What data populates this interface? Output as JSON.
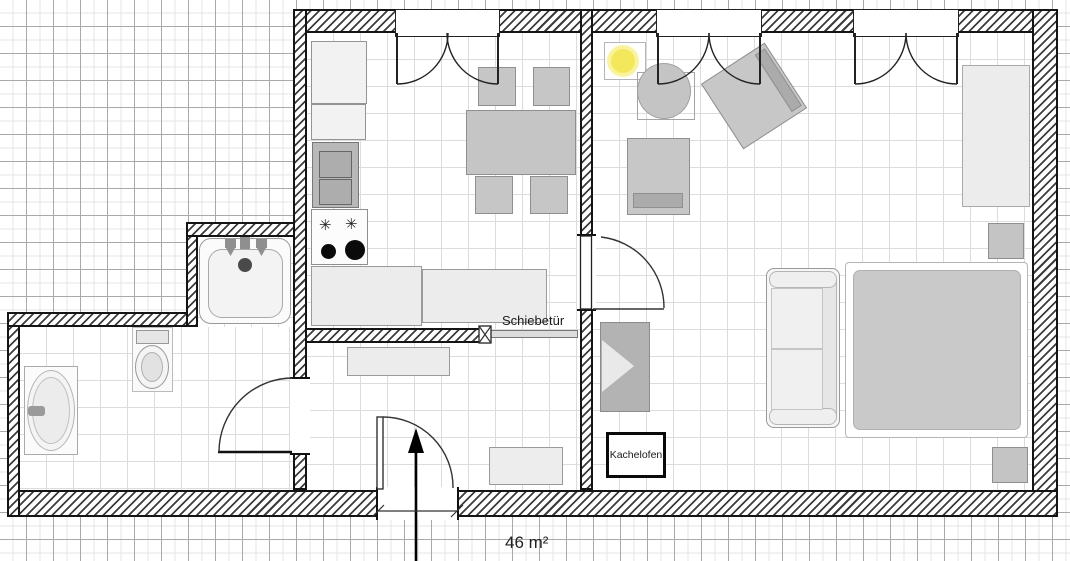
{
  "title": "apartment-floorplan",
  "labels": {
    "sliding_door": "Schiebetür",
    "tiled_stove": "Kachelofen",
    "area": "46 m²"
  },
  "symbols": {
    "gas_burner": "✳"
  },
  "rooms": [
    "kitchen-dining",
    "living-area",
    "sleeping-area",
    "bathroom",
    "hallway"
  ],
  "colors": {
    "wall_line": "#141414",
    "furniture_gray": "#c6c6c6",
    "floor_white": "#ffffff",
    "grid_major": "#a9a9a9",
    "grid_minor": "#e4e4e4",
    "lamp_yellow": "#f3e75c"
  }
}
